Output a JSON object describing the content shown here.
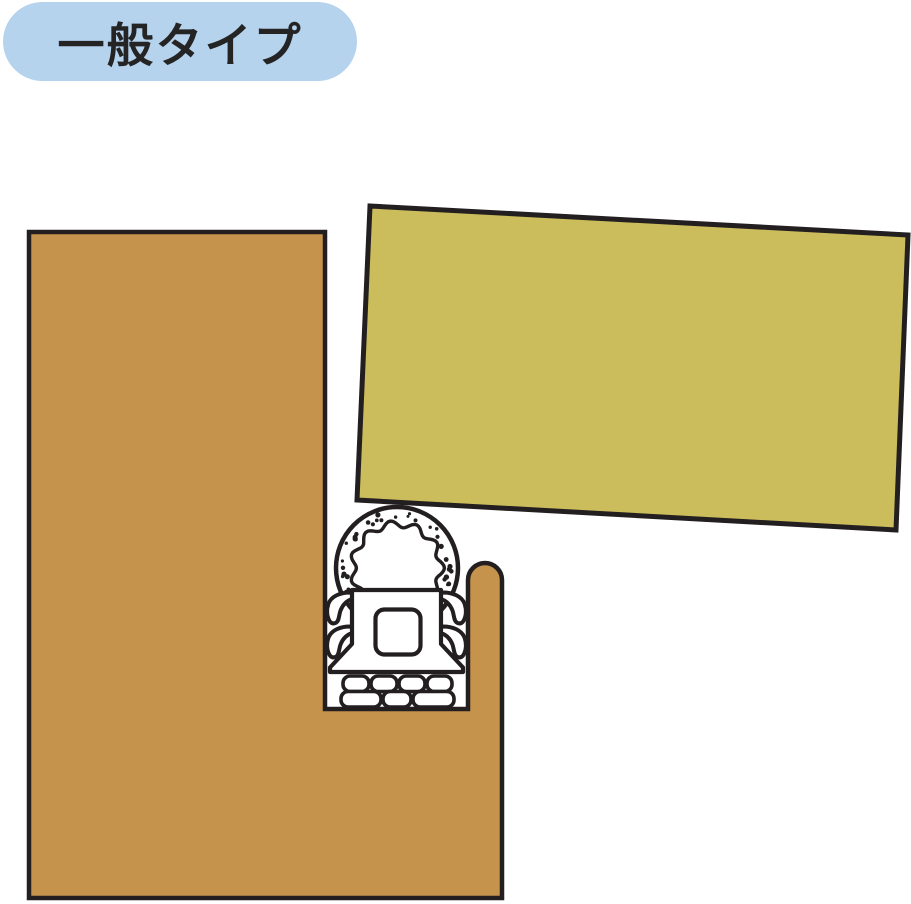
{
  "title_badge": {
    "label": "一般タイプ"
  },
  "colors": {
    "background": "#FFFFFF",
    "badge_bg": "#B6D3EE",
    "badge_text": "#242424",
    "frame_wood": "#C6934C",
    "door_panel": "#CBBD5C",
    "outline_ink": "#231F20",
    "seal_white": "#FFFFFF"
  }
}
